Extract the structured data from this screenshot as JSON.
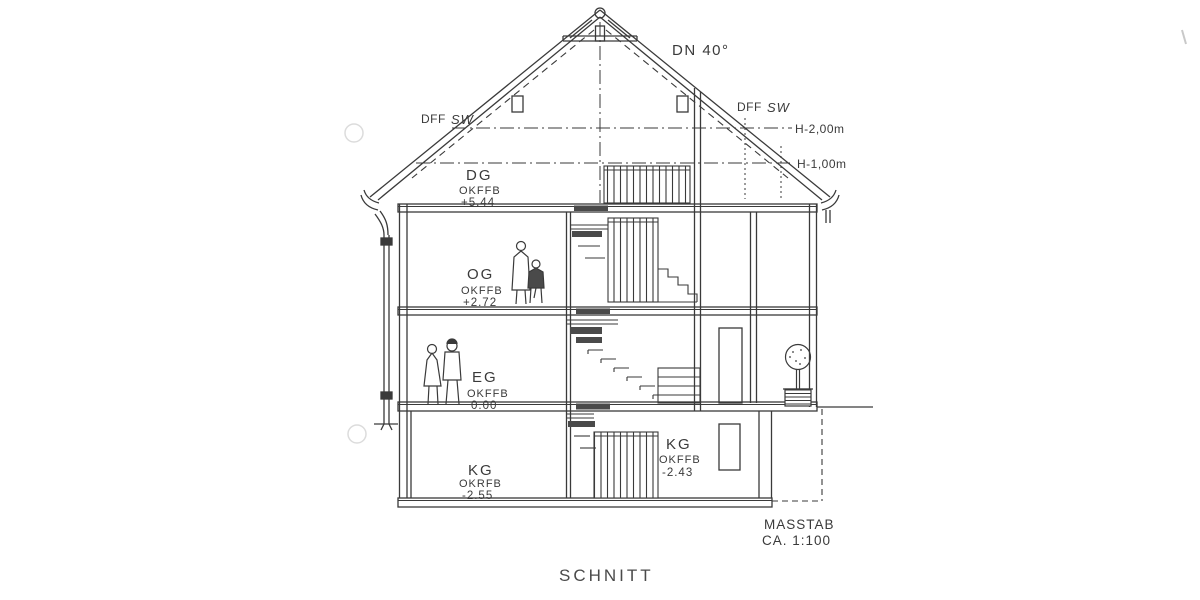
{
  "colors": {
    "ink": "#3a3a3a",
    "paper": "#ffffff"
  },
  "title": "SCHNITT",
  "scale": {
    "line1": "MASSTAB",
    "line2": "CA. 1:100"
  },
  "roof": {
    "pitch": "DN 40°",
    "dff_left": {
      "abbr": "DFF",
      "script": "SW"
    },
    "dff_right": {
      "abbr": "DFF",
      "script": "SW"
    },
    "height_upper": "H-2,00m",
    "height_lower": "H-1,00m"
  },
  "levels": {
    "dg": {
      "name": "DG",
      "datum": "OKFFB",
      "value": "+5.44"
    },
    "og": {
      "name": "OG",
      "datum": "OKFFB",
      "value": "+2.72"
    },
    "eg": {
      "name": "EG",
      "datum": "OKFFB",
      "value": "0.00"
    },
    "kg": {
      "name": "KG",
      "datum": "OKRFB",
      "value": "-2.55"
    },
    "kg_stair": {
      "name": "KG",
      "datum": "OKFFB",
      "value": "-2.43"
    }
  }
}
